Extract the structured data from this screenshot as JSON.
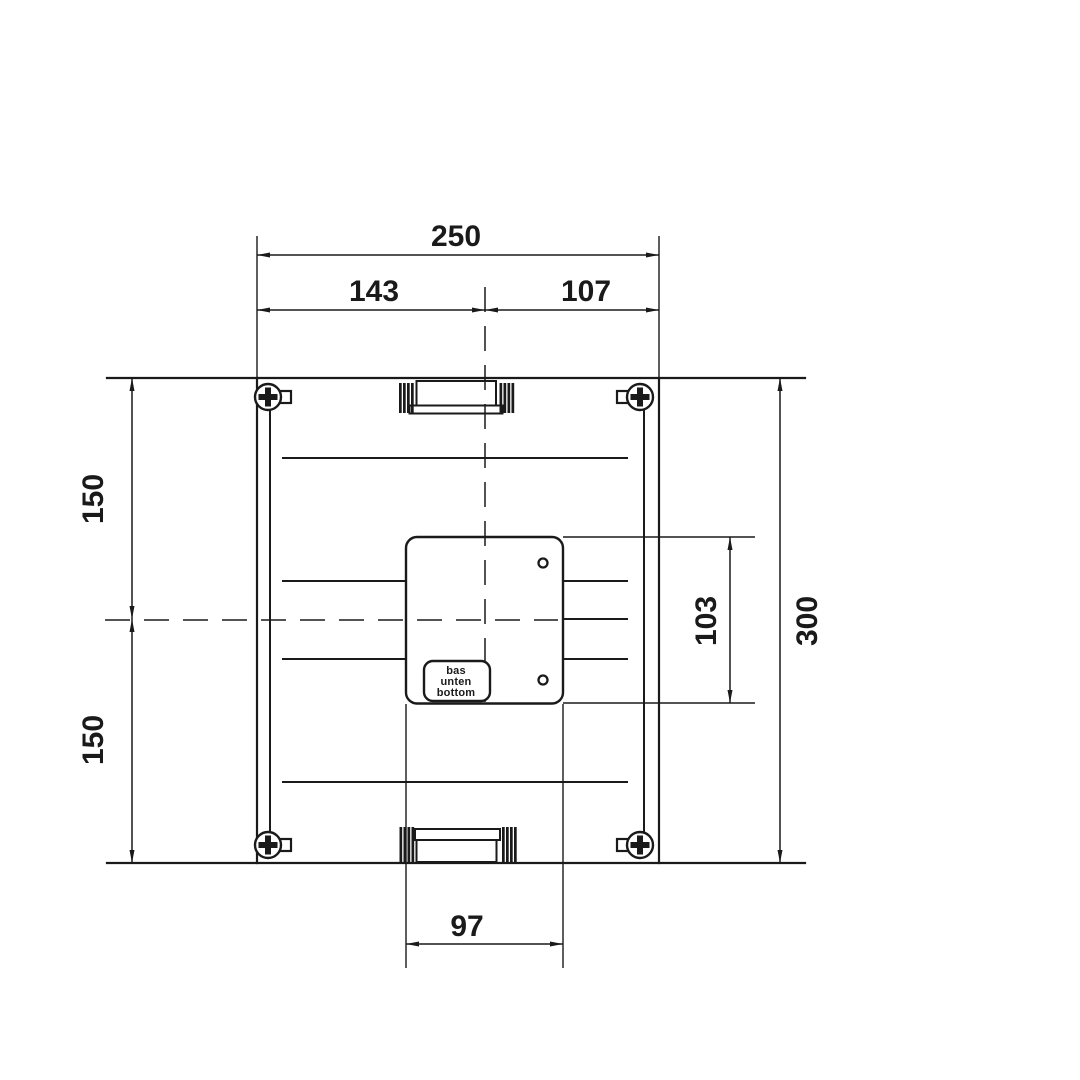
{
  "dimensions": {
    "total_width": "250",
    "left_to_center": "143",
    "center_to_right": "107",
    "top_half_height": "150",
    "bottom_half_height": "150",
    "total_height": "300",
    "box_height": "103",
    "box_width": "97"
  },
  "orientation_label": {
    "line1": "bas",
    "line2": "unten",
    "line3": "bottom"
  },
  "colors": {
    "ink": "#1a1a1a",
    "background": "#ffffff"
  }
}
